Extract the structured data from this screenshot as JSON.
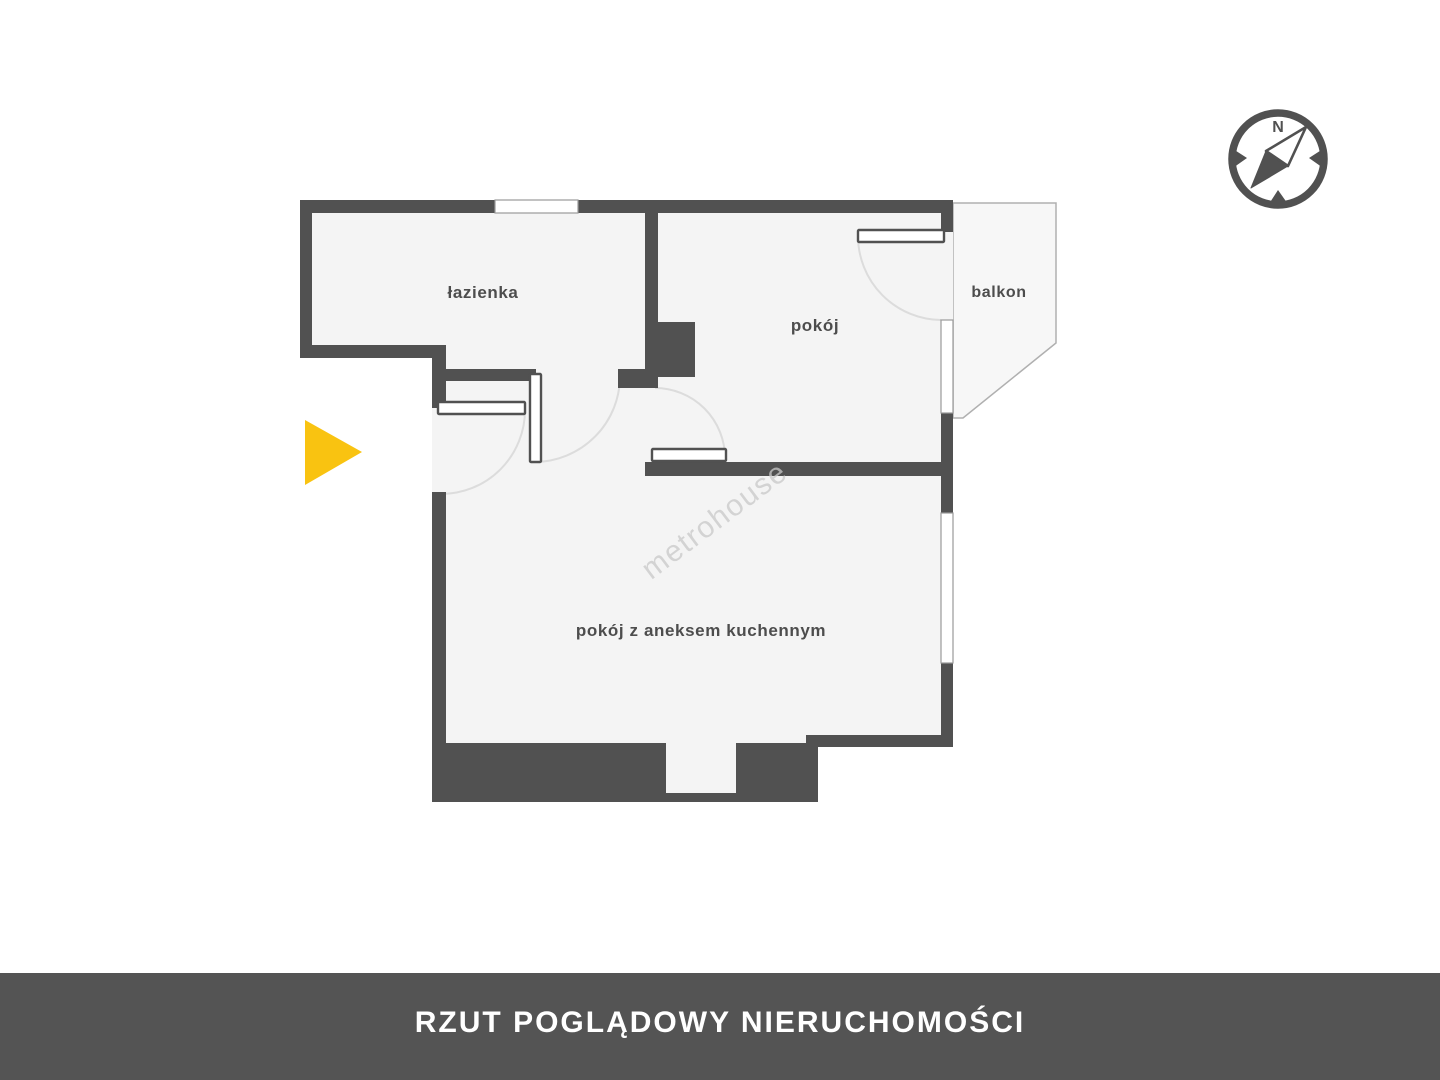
{
  "banner": {
    "label": "RZUT POGLĄDOWY NIERUCHOMOŚCI"
  },
  "compass": {
    "north_label": "N"
  },
  "watermark": {
    "text": "metrohouse"
  },
  "rooms": {
    "bathroom": {
      "label": "łazienka"
    },
    "room": {
      "label": "pokój"
    },
    "balcony": {
      "label": "balkon"
    },
    "living_kitchen": {
      "label": "pokój z aneksem kuchennym"
    }
  },
  "entrance_marker": {
    "direction": "right"
  },
  "colors": {
    "wall": "#515151",
    "floor": "#f4f4f4",
    "banner_bg": "#545454",
    "banner_text": "#ffffff",
    "accent_yellow": "#f9c311",
    "watermark": "#c9c9c9",
    "label": "#4d4d4d",
    "arc": "#dcdcdc",
    "balcony_fill": "#f7f7f7",
    "balcony_outline": "#b0b0b0",
    "window_outline": "#9a9a9a"
  }
}
